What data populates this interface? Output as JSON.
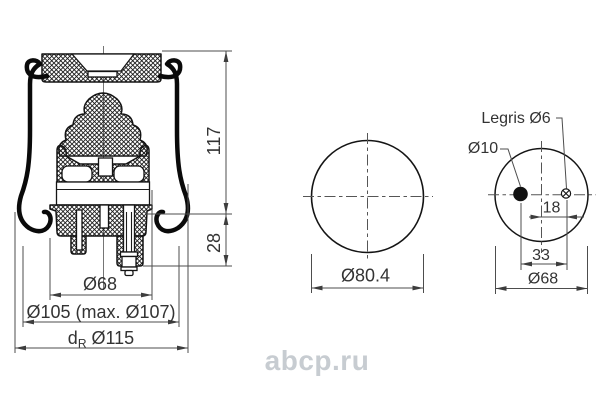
{
  "drawing_type": "air spring technical drawing",
  "left_view": {
    "dim_height": "117",
    "dim_lower": "28",
    "dim_piston": "Ø68",
    "dim_bellows_max": "Ø105 (max. Ø107)",
    "dim_rolling": {
      "prefix": "d",
      "sub": "R",
      "value": "Ø115"
    }
  },
  "middle_view": {
    "dim_diameter": "Ø80.4"
  },
  "right_view": {
    "label_port": "Legris Ø6",
    "label_hole": "Ø10",
    "dim_port_offset": "18",
    "dim_hole_spacing": "33",
    "dim_plate": "Ø68"
  },
  "watermark": {
    "text": "abcp.ru",
    "color": "#c7ccd1"
  },
  "colors": {
    "line": "#141414",
    "dimension": "#4d4d4d",
    "text": "#333333",
    "background": "#ffffff"
  }
}
